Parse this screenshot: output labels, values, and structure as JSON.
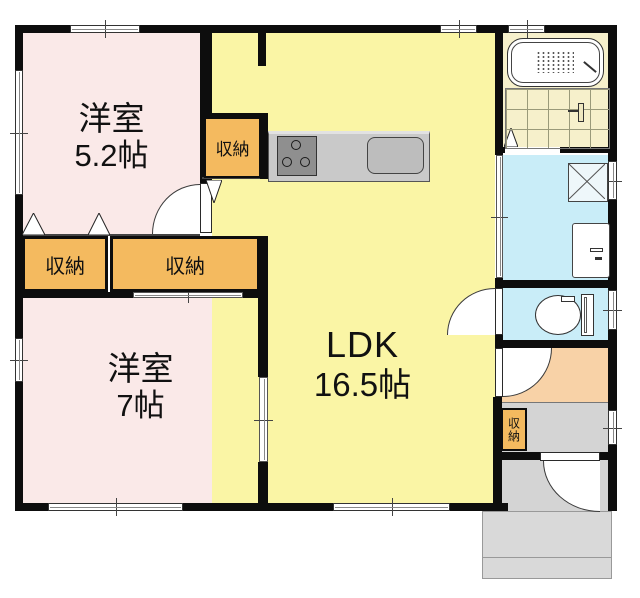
{
  "rooms": {
    "room52": {
      "name": "洋室",
      "size": "5.2帖"
    },
    "room7": {
      "name": "洋室",
      "size": "7帖"
    },
    "ldk": {
      "name": "LDK",
      "size": "16.5帖"
    }
  },
  "closets": {
    "upper": "収納",
    "left": "収納",
    "right": "収納",
    "entry": "収納"
  },
  "colors": {
    "room_pink": "#fae9e8",
    "ldk_yellow": "#faf5a5",
    "closet_orange": "#f4ba5f",
    "hall_peach": "#f8d2a7",
    "wet_blue": "#c9edf8",
    "bath_cream": "#f6f0cb",
    "entry_gray": "#d4d4d4",
    "porch_gray": "#d9d9d9",
    "counter_gray": "#c9c9c9",
    "stove_gray": "#8f8f8f",
    "sink_gray": "#bdbdbd",
    "wall_black": "#0d0d0d"
  }
}
